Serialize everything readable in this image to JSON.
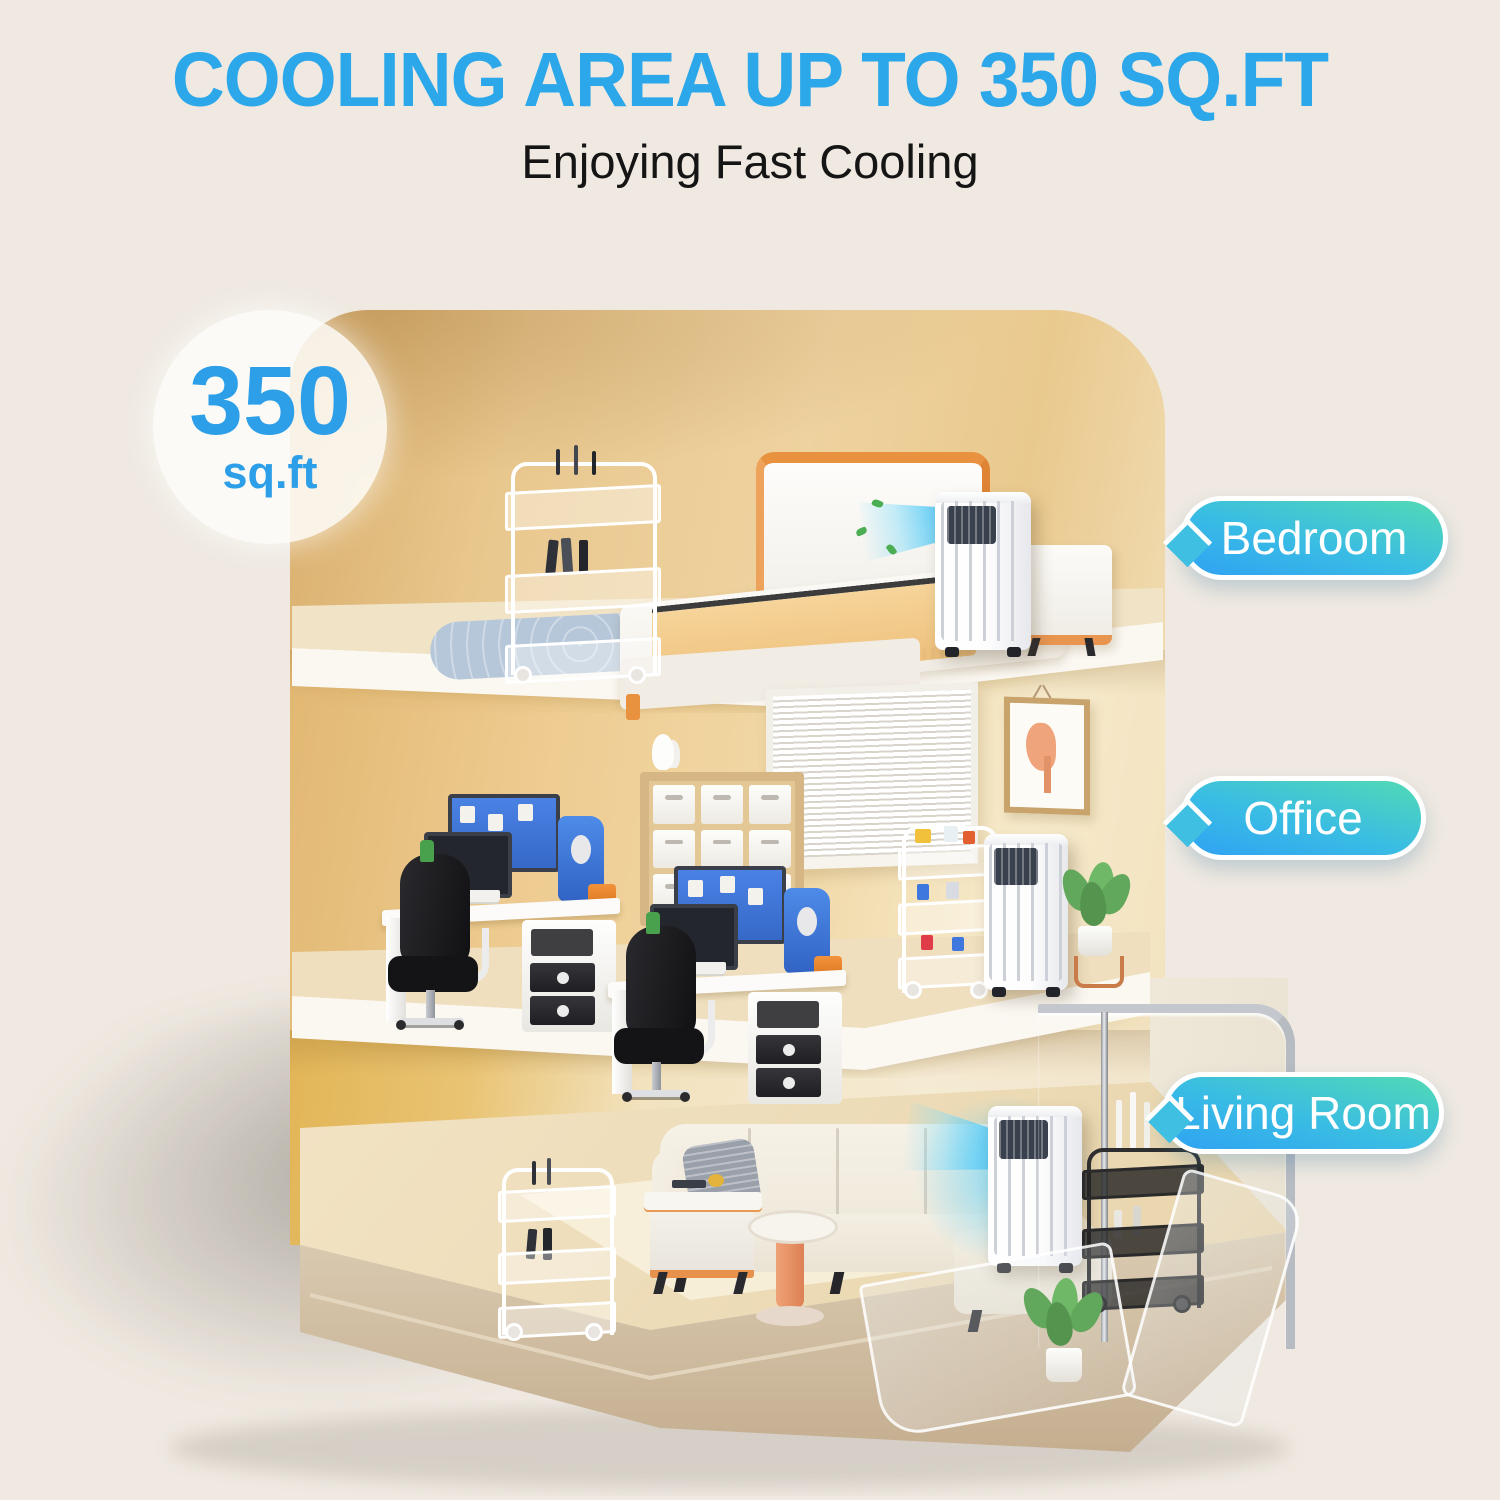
{
  "page": {
    "background": "#EFE9E1"
  },
  "header": {
    "title": "COOLING AREA UP TO 350 SQ.FT",
    "subtitle": "Enjoying Fast Cooling",
    "title_color": "#2BA7EA",
    "subtitle_color": "#151515"
  },
  "badge": {
    "value": "350",
    "unit": "sq.ft",
    "text_color": "#2D9FE8"
  },
  "room_labels": [
    {
      "id": "bedroom",
      "text": "Bedroom"
    },
    {
      "id": "office",
      "text": "Office"
    },
    {
      "id": "living-room",
      "text": "Living Room"
    }
  ],
  "label_style": {
    "gradient_top": "#52DAB4",
    "gradient_bottom": "#2FA2F3",
    "border": "#FFFFFF",
    "text_color": "#FFFFFF"
  },
  "icons": {
    "airflow": "cool-air-fan-shape",
    "leaf": "green-leaf-dot"
  },
  "colors": {
    "wall_tan": "#EACB96",
    "wall_gold": "#E2B557",
    "floor_wood": "#EFDEBB",
    "slab_edge_white": "#FBF8F2",
    "base_plinth": "#CDB698",
    "cool_air_blue": "#54C9F5",
    "rug_blue": "#B5C7D9",
    "accent_orange": "#E8913F"
  }
}
